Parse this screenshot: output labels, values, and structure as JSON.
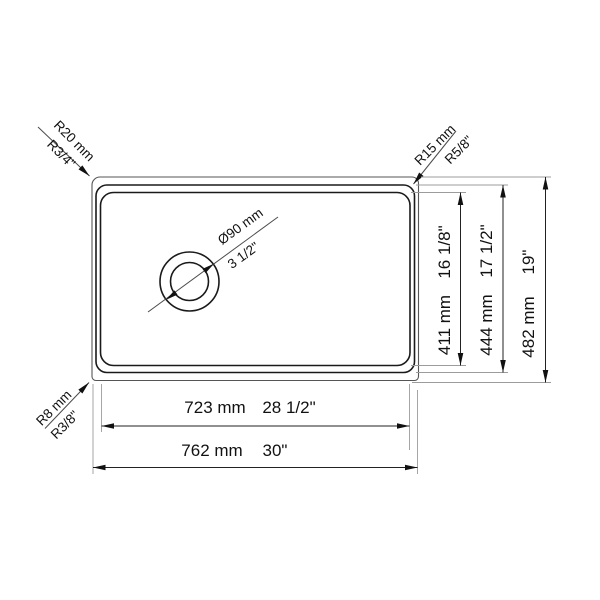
{
  "drawing": {
    "title": "sink-top-view-technical-drawing",
    "background": "#ffffff",
    "line_color": "#3c3c3c",
    "bowl_line_color": "#1a1a1a",
    "extension_line_color": "#9c9c9c",
    "text_color": "#111111"
  },
  "dimensions": {
    "outer_width_mm": 762,
    "inner_width_mm": 723,
    "outer_height_mm": 482,
    "rim_height_mm": 444,
    "inner_height_mm": 411,
    "drain_diameter_mm": 90,
    "corner_radius_top_left_mm": 20,
    "corner_radius_top_right_mm": 15,
    "corner_radius_bottom_left_mm": 8
  },
  "labels": {
    "radius_top_left": {
      "mm": "R20 mm",
      "inch": "R3/4\""
    },
    "radius_top_right": {
      "mm": "R15 mm",
      "inch": "R5/8\""
    },
    "radius_bottom_left": {
      "mm": "R8 mm",
      "inch": "R3/8\""
    },
    "drain": {
      "mm": "Ø90 mm",
      "inch": "3 1/2\""
    },
    "height_inner": {
      "mm": "411 mm",
      "inch": "16 1/8\""
    },
    "height_rim": {
      "mm": "444 mm",
      "inch": "17 1/2\""
    },
    "height_outer": {
      "mm": "482 mm",
      "inch": "19\""
    },
    "width_inner": {
      "mm": "723 mm",
      "inch": "28 1/2\""
    },
    "width_outer": {
      "mm": "762 mm",
      "inch": "30\""
    }
  }
}
